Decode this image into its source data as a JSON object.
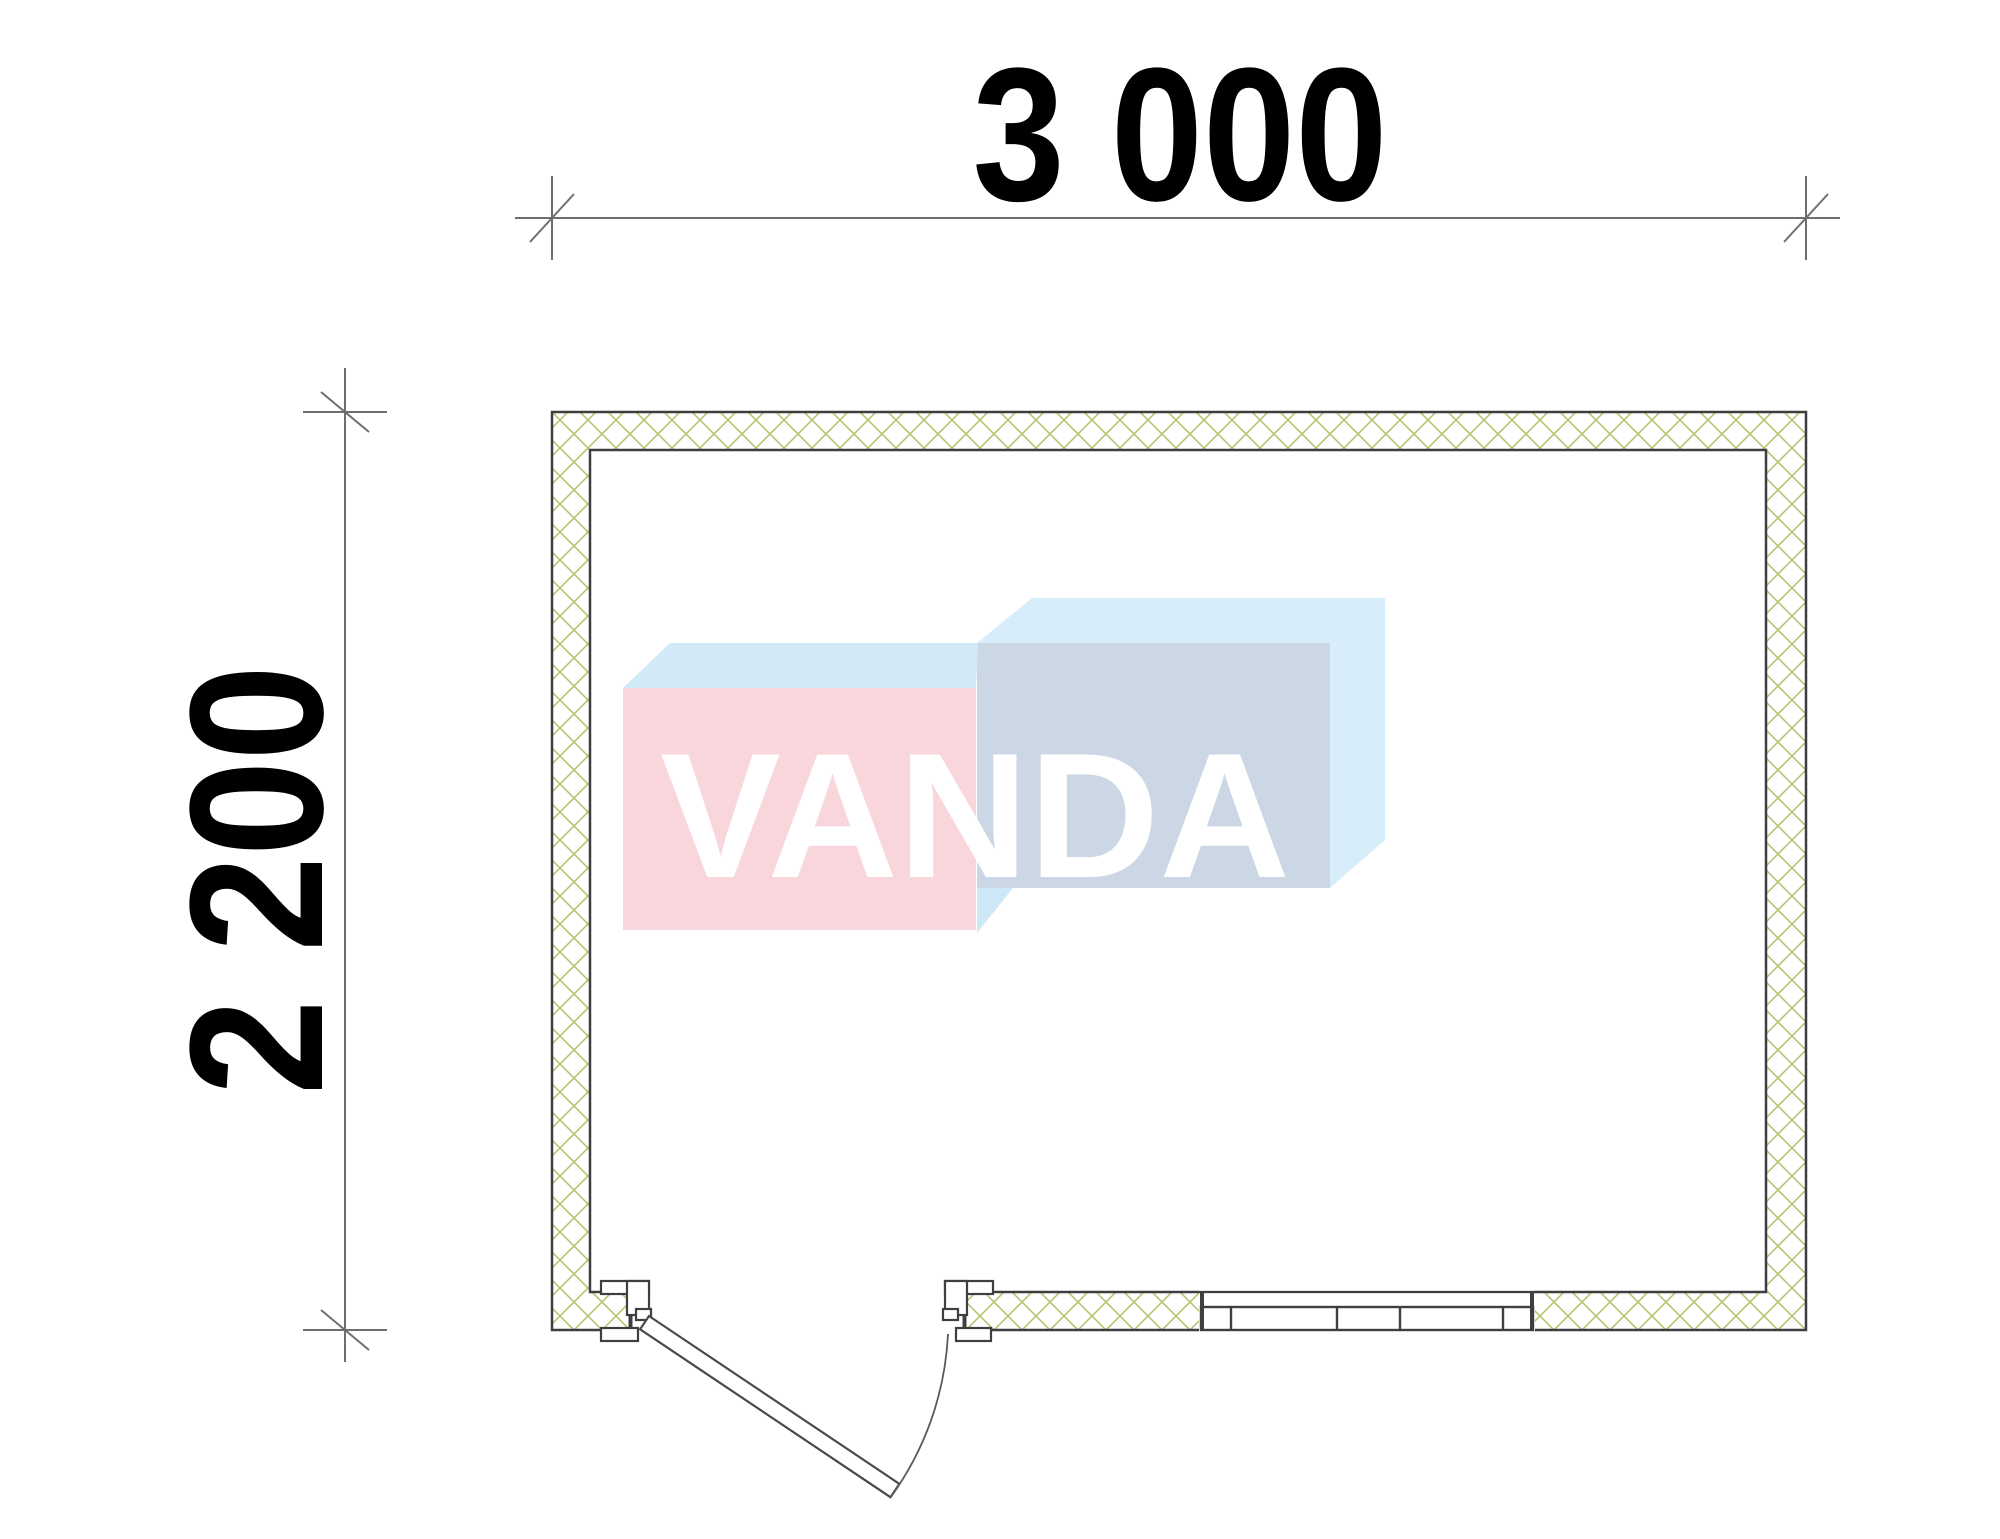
{
  "dimensions": {
    "width_label": "3 000",
    "height_label": "2 200"
  },
  "watermark": {
    "text": "VANDA"
  },
  "colors": {
    "background": "#ffffff",
    "wall_outline": "#3f3f42",
    "hatch": "#b9c371",
    "dim_line": "#6e6e6e",
    "dim_text": "#000000",
    "door_line": "#4a4a4a",
    "arc_line": "#5a5a5a",
    "logo_pink_front": "#f8d6db",
    "logo_pink_top": "#d2e9f7",
    "logo_blue_front": "#ccd7e5",
    "logo_blue_top": "#d8edfa",
    "logo_sliver": "#cfe8f7",
    "logo_letters": "#ffffff"
  }
}
